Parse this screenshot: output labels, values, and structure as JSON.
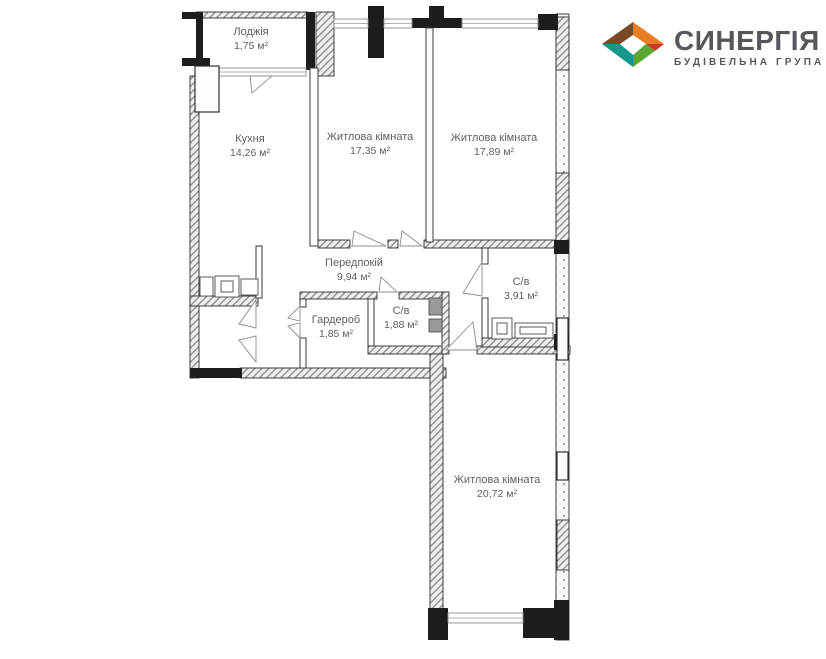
{
  "brand": {
    "name": "СИНЕРГІЯ",
    "tagline": "БУДІВЕЛЬНА ГРУПА",
    "text_color": "#55575A",
    "logo_colors": {
      "brown": "#7A4A28",
      "orange": "#E97E22",
      "red": "#D0392B",
      "green": "#58A636",
      "teal": "#14988C"
    }
  },
  "plan": {
    "type": "apartment-floor-plan",
    "rooms": [
      {
        "id": "loggia",
        "name": "Лоджія",
        "area": "1,75 м²"
      },
      {
        "id": "kitchen",
        "name": "Кухня",
        "area": "14,26 м²"
      },
      {
        "id": "living-room-1",
        "name": "Житлова кімната",
        "area": "17,35 м²"
      },
      {
        "id": "living-room-2",
        "name": "Житлова кімната",
        "area": "17,89 м²"
      },
      {
        "id": "hallway",
        "name": "Передпокій",
        "area": "9,94 м²"
      },
      {
        "id": "bathroom",
        "name": "С/в",
        "area": "3,91 м²"
      },
      {
        "id": "wardrobe",
        "name": "Гардероб",
        "area": "1,85 м²"
      },
      {
        "id": "wc",
        "name": "С/в",
        "area": "1,88 м²"
      },
      {
        "id": "living-room-3",
        "name": "Житлова кімната",
        "area": "20,72 м²"
      }
    ]
  }
}
